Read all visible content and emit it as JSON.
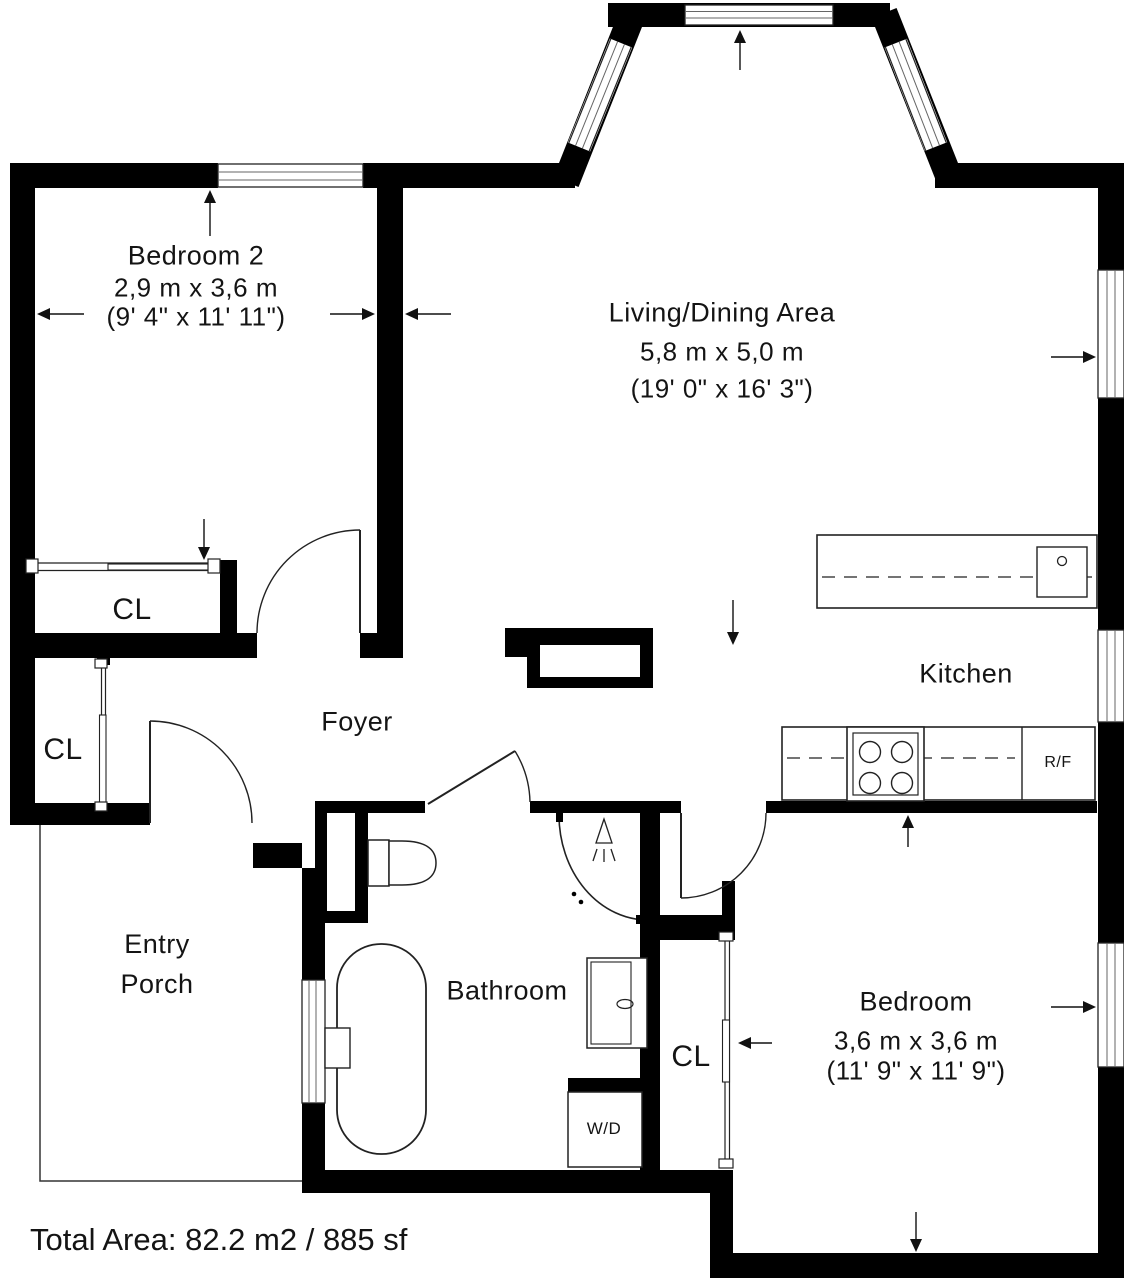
{
  "rooms": {
    "bedroom2": {
      "name": "Bedroom 2",
      "metric": "2,9 m x 3,6 m",
      "imperial": "(9' 4\" x 11' 11\")"
    },
    "living": {
      "name": "Living/Dining Area",
      "metric": "5,8 m x 5,0 m",
      "imperial": "(19' 0\" x 16' 3\")"
    },
    "foyer": {
      "name": "Foyer"
    },
    "kitchen": {
      "name": "Kitchen"
    },
    "bathroom": {
      "name": "Bathroom"
    },
    "entry_porch": {
      "line1": "Entry",
      "line2": "Porch"
    },
    "bedroom": {
      "name": "Bedroom",
      "metric": "3,6 m x 3,6 m",
      "imperial": "(11' 9\" x 11' 9\")"
    }
  },
  "closets": {
    "upper": "CL",
    "left": "CL",
    "bedroom": "CL"
  },
  "appliances": {
    "fridge": "R/F",
    "washer_dryer": "W/D"
  },
  "footer": {
    "total_area": "Total Area: 82.2 m2 / 885 sf"
  },
  "colors": {
    "wall": "#000000",
    "background": "#ffffff",
    "fixture_line": "#222222"
  }
}
